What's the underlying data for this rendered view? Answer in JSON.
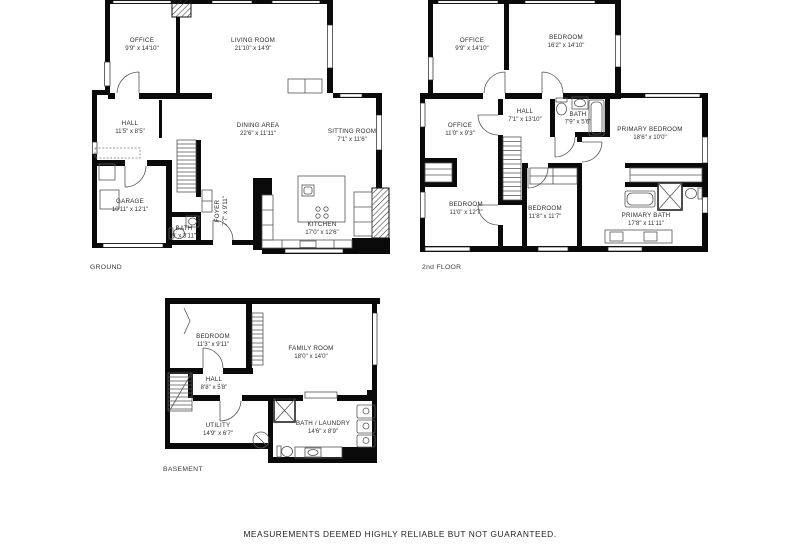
{
  "colors": {
    "wall": "#0a0a0a",
    "line": "#555555",
    "text": "#2b2b2b",
    "background": "#ffffff"
  },
  "footer": {
    "disclaimer": "MEASUREMENTS DEEMED HIGHLY RELIABLE BUT NOT GUARANTEED."
  },
  "floors": {
    "ground": {
      "label": "GROUND",
      "rooms": {
        "office": {
          "name": "OFFICE",
          "dims": "9'9\" x 14'10\""
        },
        "living_room": {
          "name": "LIVING ROOM",
          "dims": "21'10\" x 14'9\""
        },
        "hall": {
          "name": "HALL",
          "dims": "11'5\" x 8'5\""
        },
        "dining_area": {
          "name": "DINING AREA",
          "dims": "22'6\" x 11'11\""
        },
        "sitting_room": {
          "name": "SITTING ROOM",
          "dims": "7'1\" x 11'6\""
        },
        "garage": {
          "name": "GARAGE",
          "dims": "10'11\" x 12'1\""
        },
        "foyer": {
          "name": "FOYER",
          "dims": "7'7\" x 9'11\""
        },
        "bath": {
          "name": "BATH",
          "dims": "9' x 3'11\""
        },
        "kitchen": {
          "name": "KITCHEN",
          "dims": "17'0\" x 12'6\""
        }
      }
    },
    "second": {
      "label": "2nd FLOOR",
      "rooms": {
        "office_upper": {
          "name": "OFFICE",
          "dims": "9'9\" x 14'10\""
        },
        "bedroom_upper": {
          "name": "BEDROOM",
          "dims": "16'2\" x 14'10\""
        },
        "hall": {
          "name": "HALL",
          "dims": "7'1\" x 13'10\""
        },
        "bath": {
          "name": "BATH",
          "dims": "7'9\" x 5'6\""
        },
        "office_mid": {
          "name": "OFFICE",
          "dims": "11'0\" x 9'3\""
        },
        "primary_bedroom": {
          "name": "PRIMARY BEDROOM",
          "dims": "18'6\" x 10'0\""
        },
        "bedroom_left": {
          "name": "BEDROOM",
          "dims": "11'0\" x 12'7\""
        },
        "bedroom_mid": {
          "name": "BEDROOM",
          "dims": "11'8\" x 11'7\""
        },
        "primary_bath": {
          "name": "PRIMARY BATH",
          "dims": "17'8\" x 11'11\""
        }
      }
    },
    "basement": {
      "label": "BASEMENT",
      "rooms": {
        "bedroom": {
          "name": "BEDROOM",
          "dims": "11'3\" x 9'11\""
        },
        "family_room": {
          "name": "FAMILY ROOM",
          "dims": "18'0\" x 14'0\""
        },
        "hall": {
          "name": "HALL",
          "dims": "8'8\" x 5'8\""
        },
        "utility": {
          "name": "UTILITY",
          "dims": "14'9\" x 6'7\""
        },
        "bath_laundry": {
          "name": "BATH / LAUNDRY",
          "dims": "14'6\" x 8'9\""
        }
      }
    }
  }
}
